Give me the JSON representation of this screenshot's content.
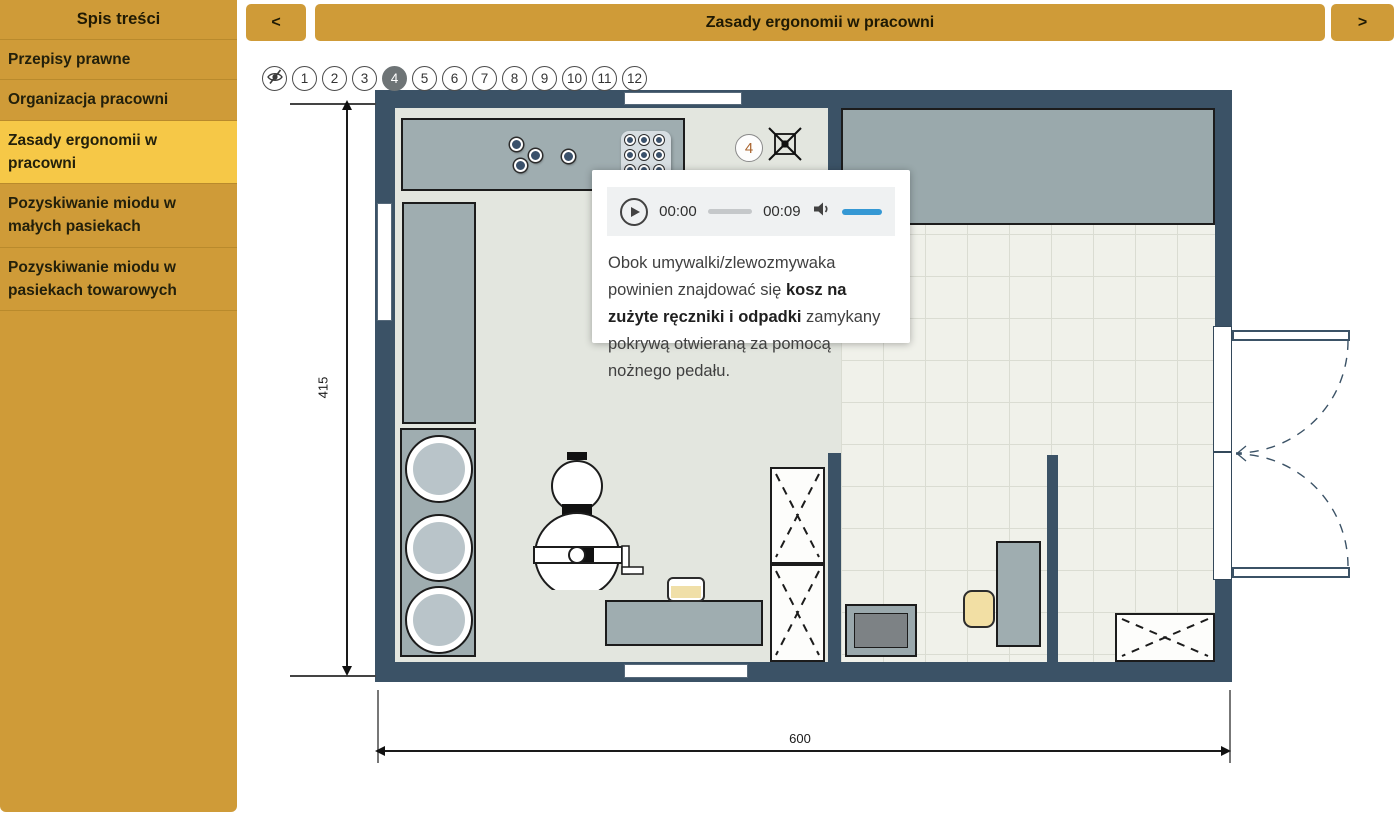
{
  "sidebar": {
    "title": "Spis treści",
    "active_index": 2,
    "items": [
      {
        "label": "Przepisy prawne"
      },
      {
        "label": "Organizacja pracowni"
      },
      {
        "label": "Zasady ergonomii w pracowni"
      },
      {
        "label": "Pozyskiwanie miodu w małych pasiekach"
      },
      {
        "label": "Pozyskiwanie miodu w pasiekach towarowych"
      }
    ]
  },
  "topbar": {
    "prev_label": "<",
    "next_label": ">",
    "title": "Zasady ergonomii w pracowni"
  },
  "stepper": {
    "active": "4",
    "steps": [
      "1",
      "2",
      "3",
      "4",
      "5",
      "6",
      "7",
      "8",
      "9",
      "10",
      "11",
      "12"
    ],
    "hide_icon": "eye-off"
  },
  "popup": {
    "player": {
      "current_time": "00:00",
      "duration": "00:09",
      "play_icon": "play",
      "speaker_icon": "speaker",
      "volume_color": "#3598d4"
    },
    "text_before": "Obok umywalki/zlewozmywaka powinien znajdować się ",
    "text_bold": "kosz na zużyte ręczniki i odpadki",
    "text_after": " zamykany pokrywą otwieraną za pomocą nożnego pedału."
  },
  "plan": {
    "marker_label": "4",
    "marker_icon": "crossed-bin",
    "height_dim": "415",
    "width_dim": "600"
  },
  "colors": {
    "gold": "#cf9b38",
    "gold_active": "#f6c847",
    "wall": "#3b5266",
    "accent_blue": "#3598d4",
    "active_step": "#6e7476"
  }
}
